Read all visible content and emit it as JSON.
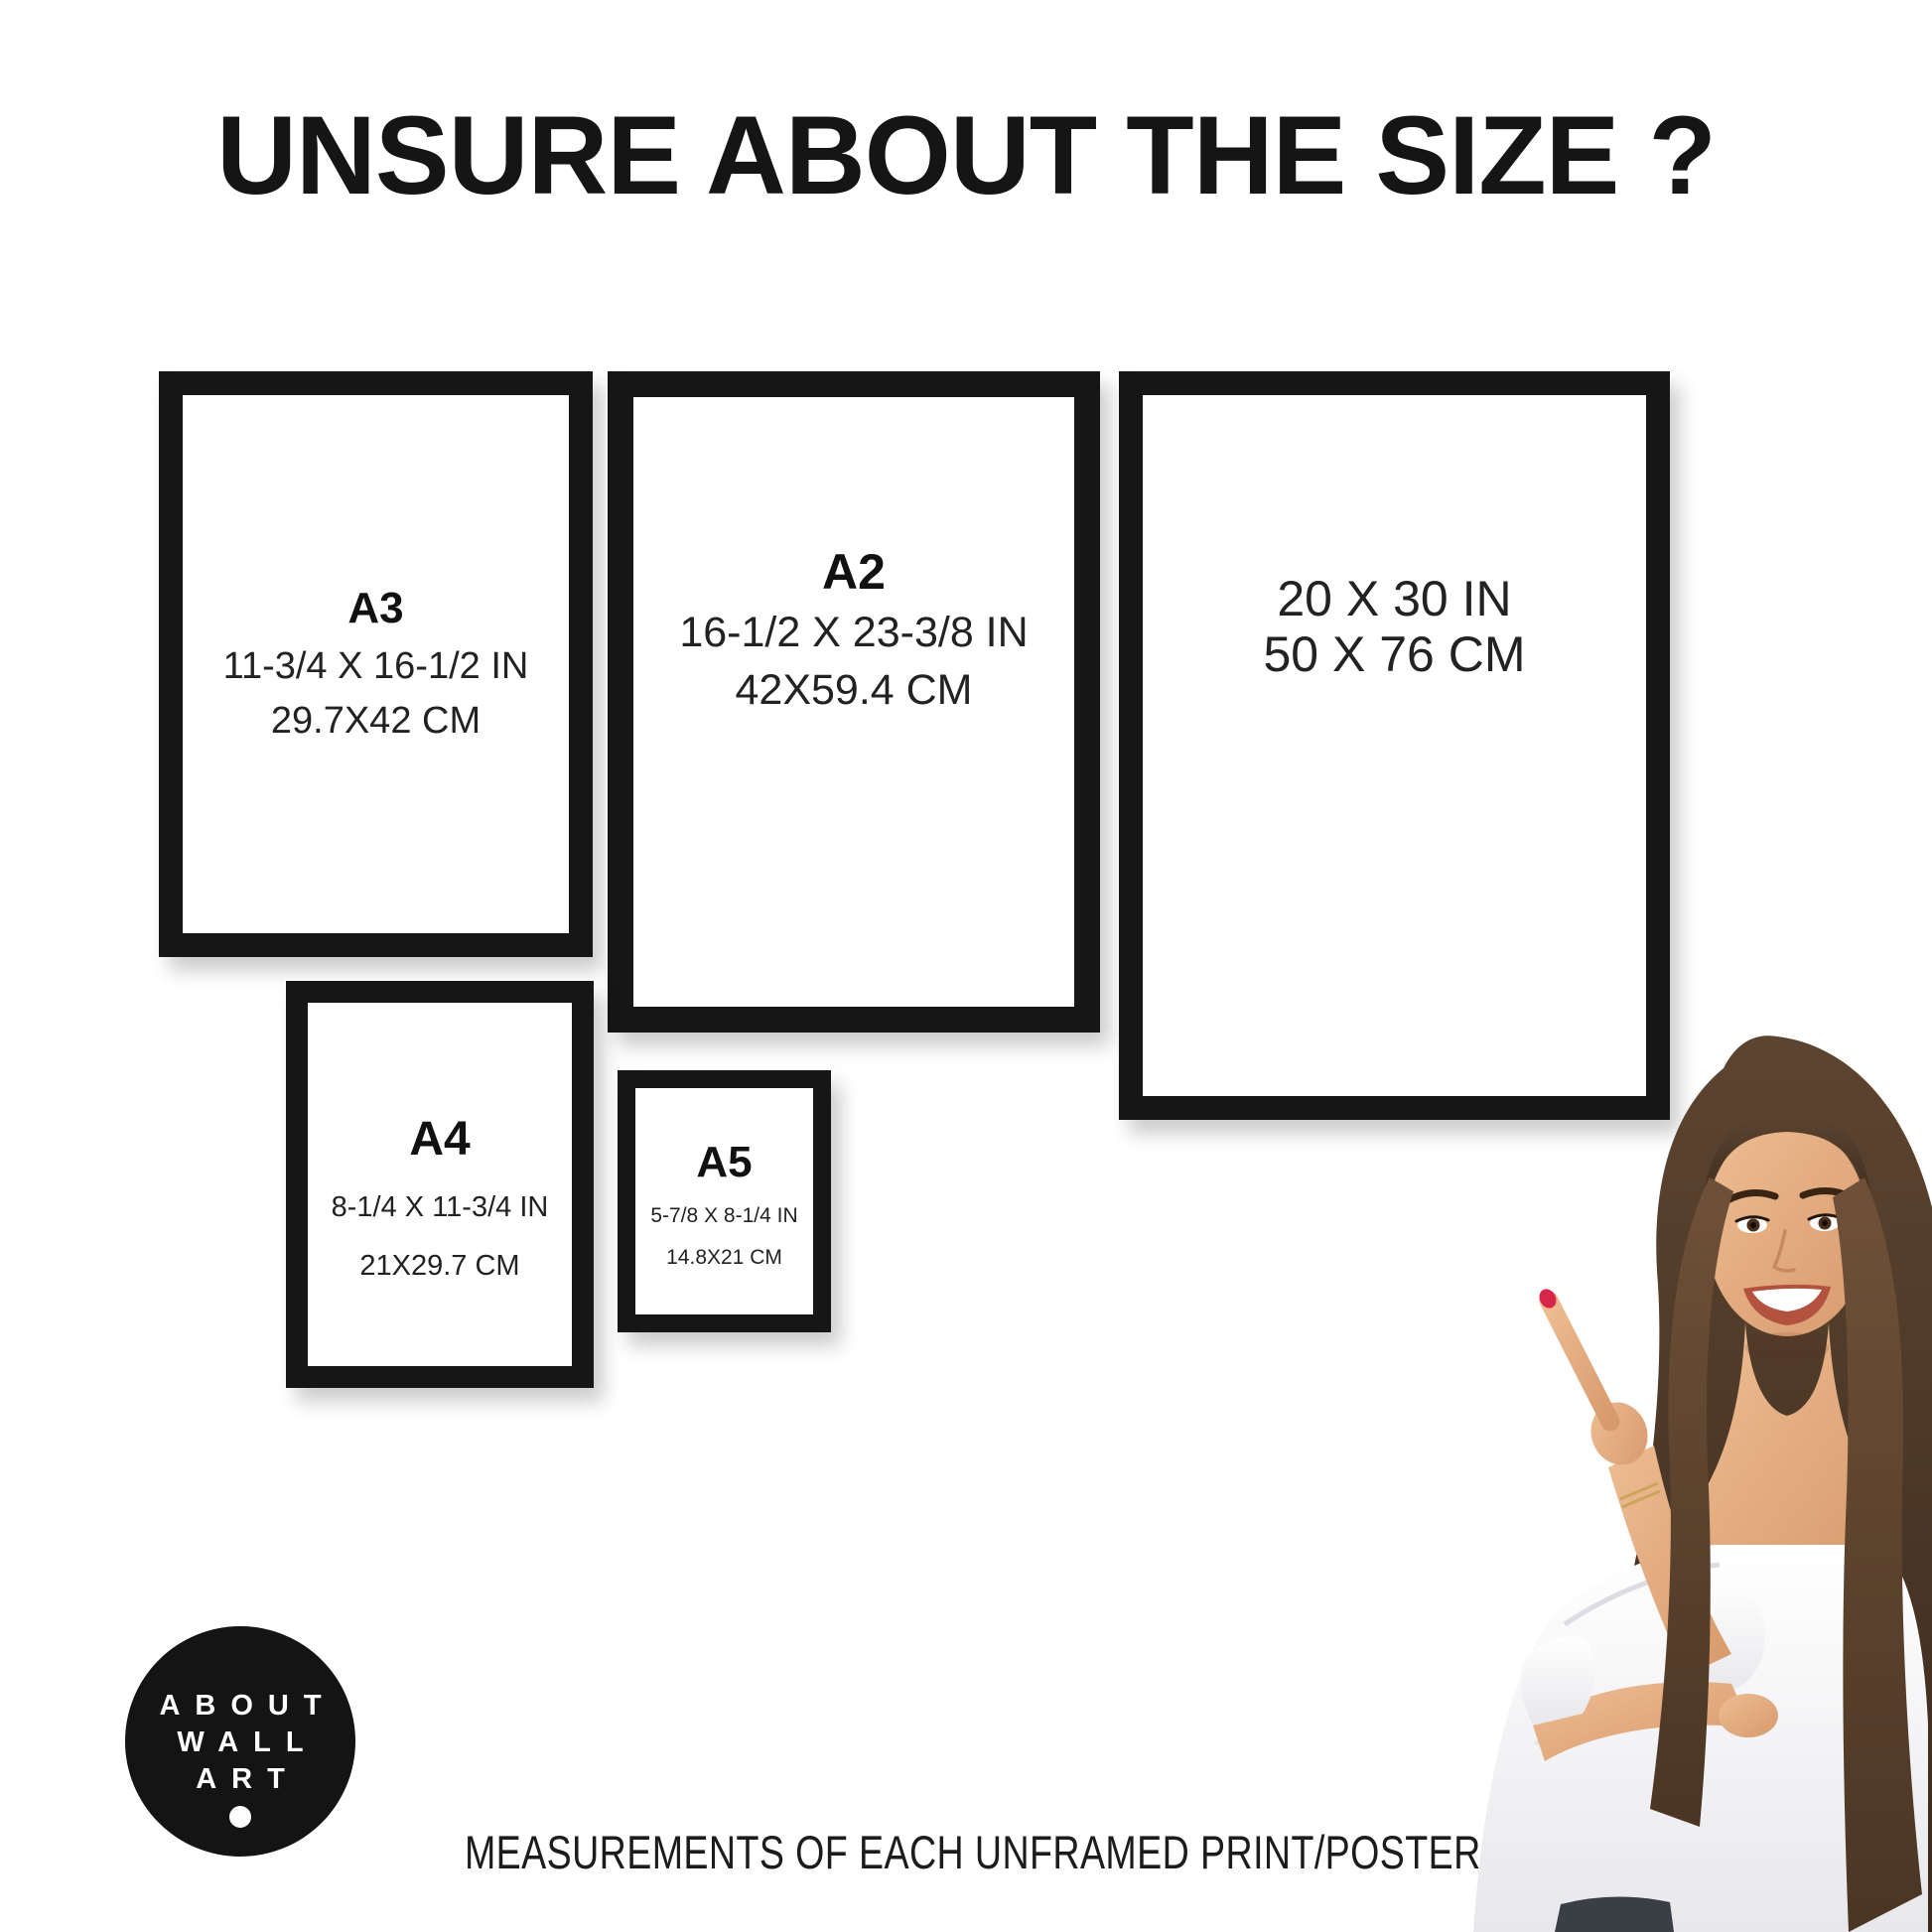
{
  "title": "UNSURE ABOUT THE SIZE ?",
  "frames": {
    "a3": {
      "label": "A3",
      "inches": "11-3/4 X 16-1/2 IN",
      "cm": "29.7X42 CM"
    },
    "a2": {
      "label": "A2",
      "inches": "16-1/2 X 23-3/8 IN",
      "cm": "42X59.4 CM"
    },
    "poster2030": {
      "inches": "20 X 30 IN",
      "cm": "50 X 76 CM"
    },
    "a4": {
      "label": "A4",
      "inches": "8-1/4 X 11-3/4 IN",
      "cm": "21X29.7 CM"
    },
    "a5": {
      "label": "A5",
      "inches": "5-7/8 X 8-1/4 IN",
      "cm": "14.8X21 CM"
    }
  },
  "logo": {
    "line1": "ABOUT",
    "line2": "WALL",
    "line3": "ART"
  },
  "caption": "MEASUREMENTS OF EACH UNFRAMED PRINT/POSTER",
  "colors": {
    "background": "#ffffff",
    "frame_border": "#161616",
    "text": "#1f1f1f",
    "logo_background": "#141414",
    "logo_text": "#ffffff",
    "nail_polish": "#d6264a",
    "hair_brown": "#4e3826",
    "blouse_white": "#f4f4f6"
  }
}
